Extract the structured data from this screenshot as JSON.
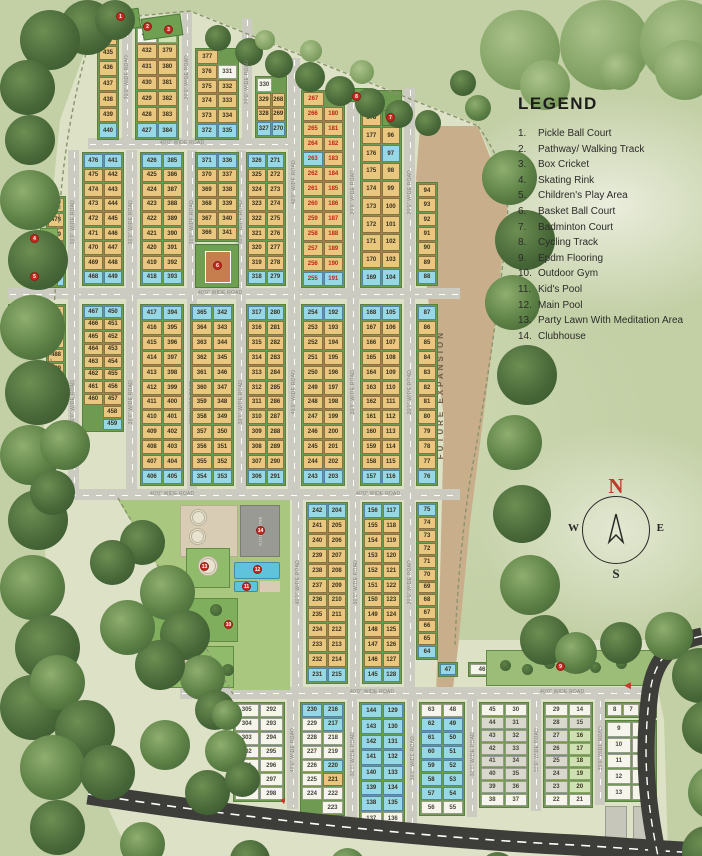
{
  "legend": {
    "title": "LEGEND",
    "items": [
      {
        "num": "1.",
        "label": "Pickle Ball Court"
      },
      {
        "num": "2.",
        "label": "Pathway/ Walking Track"
      },
      {
        "num": "3.",
        "label": "Box Cricket"
      },
      {
        "num": "4.",
        "label": "Skating Rink"
      },
      {
        "num": "5.",
        "label": "Children's Play Area"
      },
      {
        "num": "6.",
        "label": "Basket Ball Court"
      },
      {
        "num": "7.",
        "label": "Badminton Court"
      },
      {
        "num": "8.",
        "label": "Cycling Track"
      },
      {
        "num": "9.",
        "label": "Epdm Flooring"
      },
      {
        "num": "10.",
        "label": "Outdoor Gym"
      },
      {
        "num": "11.",
        "label": "Kid's Pool"
      },
      {
        "num": "12.",
        "label": "Main Pool"
      },
      {
        "num": "13.",
        "label": "Party Lawn With Meditation Area"
      },
      {
        "num": "14.",
        "label": "Clubhouse"
      }
    ]
  },
  "compass": {
    "n": "N",
    "e": "E",
    "s": "S",
    "w": "W"
  },
  "labels": {
    "future_expansion": "FUTURE EXPANSION",
    "clubhouse": "CLUBHOUSE",
    "road_40": "40'0\" WIDE ROAD",
    "road_30": "30'0\" WIDE ROAD"
  },
  "colors": {
    "plot_tan": "#e9c77e",
    "plot_blue": "#97d8e6",
    "plot_white": "#f6f5ec",
    "sold_red_text": "#c22314",
    "road_gray": "#cbcbc1",
    "future_tan": "#c8ae8a",
    "hedge_green": "#6f9a52",
    "marker_red": "#c52b20",
    "main_road_dark": "#3d3d39"
  },
  "markers": {
    "m1": "1",
    "m2": "2",
    "m3": "3",
    "m4": "4",
    "m5": "5",
    "m6": "6",
    "m7": "7",
    "m8": "8",
    "m9": "9",
    "m10": "10",
    "m11": "11",
    "m12": "12",
    "m13": "13",
    "m14": "14"
  },
  "plot_groups": {
    "g434": {
      "rows": [
        [
          "434:t"
        ],
        [
          "435:t"
        ],
        [
          "436:t"
        ],
        [
          "437:t"
        ],
        [
          "438:t"
        ],
        [
          "439:t"
        ],
        [
          "440:b"
        ]
      ]
    },
    "g433": {
      "rows": [
        [
          "433:w",
          "378:gr"
        ],
        [
          "432:t",
          "379:t"
        ],
        [
          "431:t",
          "380:t"
        ],
        [
          "430:t",
          "381:t"
        ],
        [
          "429:t",
          "382:t"
        ],
        [
          "428:t",
          "383:t"
        ],
        [
          "427:b",
          "384:b"
        ]
      ]
    },
    "g377": {
      "rows": [
        [
          "377:t",
          "."
        ],
        [
          "376:t",
          "331:w"
        ],
        [
          "375:t",
          "332:t"
        ],
        [
          "374:t",
          "333:t"
        ],
        [
          "373:t",
          "334:t"
        ],
        [
          "372:b",
          "335:b"
        ]
      ]
    },
    "g330": {
      "rows": [
        [
          "330:w",
          "."
        ],
        [
          "329:t",
          "268:t"
        ],
        [
          "328:t",
          "269:t"
        ],
        [
          "327:b",
          "270:b"
        ]
      ]
    },
    "g267": {
      "rows": [
        [
          "267:r",
          "."
        ],
        [
          "266:r",
          "180:r"
        ],
        [
          "265:r",
          "181:r"
        ],
        [
          "264:r",
          "182:r"
        ],
        [
          "263:rb",
          "183:r"
        ],
        [
          "262:r",
          "184:r"
        ],
        [
          "261:r",
          "185:r"
        ],
        [
          "260:r",
          "186:r"
        ],
        [
          "259:r",
          "187:r"
        ],
        [
          "258:r",
          "188:r"
        ],
        [
          "257:r",
          "189:r"
        ],
        [
          "256:r",
          "190:r"
        ],
        [
          "255:rb",
          "191:rb"
        ]
      ]
    },
    "g179": {
      "rows": [
        [
          "179:w",
          "."
        ],
        [
          "178:t",
          "95:w"
        ],
        [
          "177:t",
          "96:t"
        ],
        [
          "176:t",
          "97:b"
        ],
        [
          "175:t",
          "98:t"
        ],
        [
          "174:t",
          "99:t"
        ],
        [
          "173:t",
          "100:t"
        ],
        [
          "172:t",
          "101:t"
        ],
        [
          "171:t",
          "102:t"
        ],
        [
          "170:t",
          "103:t"
        ],
        [
          "169:b",
          "104:b"
        ]
      ]
    },
    "g94": {
      "rows": [
        [
          "94:t"
        ],
        [
          "93:t"
        ],
        [
          "92:t"
        ],
        [
          "91:t"
        ],
        [
          "90:t"
        ],
        [
          "89:t"
        ],
        [
          "88:b"
        ]
      ]
    },
    "g477": {
      "rows": [
        [
          "477:t"
        ],
        [
          "478:t"
        ],
        [
          "479:t"
        ],
        [
          "480:t"
        ],
        [
          "481:t"
        ],
        [
          "482:b"
        ]
      ]
    },
    "g476": {
      "rows": [
        [
          "476:b",
          "441:b"
        ],
        [
          "475:t",
          "442:t"
        ],
        [
          "474:t",
          "443:t"
        ],
        [
          "473:t",
          "444:t"
        ],
        [
          "472:t",
          "445:t"
        ],
        [
          "471:t",
          "446:t"
        ],
        [
          "470:t",
          "447:t"
        ],
        [
          "469:t",
          "448:t"
        ],
        [
          "468:b",
          "449:b"
        ]
      ]
    },
    "g426": {
      "rows": [
        [
          "426:b",
          "385:b"
        ],
        [
          "425:t",
          "386:t"
        ],
        [
          "424:t",
          "387:t"
        ],
        [
          "423:t",
          "388:t"
        ],
        [
          "422:t",
          "389:t"
        ],
        [
          "421:t",
          "390:t"
        ],
        [
          "420:t",
          "391:t"
        ],
        [
          "419:t",
          "392:t"
        ],
        [
          "418:b",
          "393:b"
        ]
      ]
    },
    "g371": {
      "rows": [
        [
          "371:b",
          "336:b"
        ],
        [
          "370:t",
          "337:t"
        ],
        [
          "369:t",
          "338:t"
        ],
        [
          "368:t",
          "339:t"
        ],
        [
          "367:t",
          "340:t"
        ],
        [
          "366:t",
          "341:t"
        ]
      ]
    },
    "g326": {
      "rows": [
        [
          "326:b",
          "271:b"
        ],
        [
          "325:t",
          "272:t"
        ],
        [
          "324:t",
          "273:t"
        ],
        [
          "323:t",
          "274:t"
        ],
        [
          "322:t",
          "275:t"
        ],
        [
          "321:t",
          "276:t"
        ],
        [
          "320:t",
          "277:t"
        ],
        [
          "319:t",
          "278:t"
        ],
        [
          "318:b",
          "279:b"
        ]
      ]
    },
    "g483": {
      "rows": [
        [
          "483:w",
          "484:t"
        ]
      ]
    },
    "g485": {
      "rows": [
        [
          "485:t"
        ],
        [
          "486:t"
        ],
        [
          "487:t"
        ],
        [
          "488:t"
        ],
        [
          "489:t"
        ]
      ]
    },
    "g467": {
      "rows": [
        [
          "467:b",
          "450:b"
        ],
        [
          "466:t",
          "451:t"
        ],
        [
          "465:t",
          "452:t"
        ],
        [
          "464:t",
          "453:t"
        ],
        [
          "463:t",
          "454:t"
        ],
        [
          "462:t",
          "455:t"
        ],
        [
          "461:t",
          "456:t"
        ],
        [
          "460:t",
          "457:t"
        ],
        [
          ".",
          "458:t"
        ],
        [
          ".",
          "459:b"
        ]
      ]
    },
    "g417": {
      "rows": [
        [
          "417:b",
          "394:b"
        ],
        [
          "416:t",
          "395:t"
        ],
        [
          "415:t",
          "396:t"
        ],
        [
          "414:t",
          "397:t"
        ],
        [
          "413:t",
          "398:t"
        ],
        [
          "412:t",
          "399:t"
        ],
        [
          "411:t",
          "400:t"
        ],
        [
          "410:t",
          "401:t"
        ],
        [
          "409:t",
          "402:t"
        ],
        [
          "408:t",
          "403:t"
        ],
        [
          "407:t",
          "404:t"
        ],
        [
          "406:b",
          "405:b"
        ]
      ]
    },
    "g365": {
      "rows": [
        [
          "365:b",
          "342:b"
        ],
        [
          "364:t",
          "343:t"
        ],
        [
          "363:t",
          "344:t"
        ],
        [
          "362:t",
          "345:t"
        ],
        [
          "361:t",
          "346:t"
        ],
        [
          "360:t",
          "347:t"
        ],
        [
          "359:t",
          "348:t"
        ],
        [
          "358:t",
          "349:t"
        ],
        [
          "357:t",
          "350:t"
        ],
        [
          "356:t",
          "351:t"
        ],
        [
          "355:t",
          "352:t"
        ],
        [
          "354:b",
          "353:b"
        ]
      ]
    },
    "g317": {
      "rows": [
        [
          "317:b",
          "280:b"
        ],
        [
          "316:t",
          "281:t"
        ],
        [
          "315:t",
          "282:t"
        ],
        [
          "314:t",
          "283:t"
        ],
        [
          "313:t",
          "284:t"
        ],
        [
          "312:t",
          "285:t"
        ],
        [
          "311:t",
          "286:t"
        ],
        [
          "310:t",
          "287:t"
        ],
        [
          "309:t",
          "288:t"
        ],
        [
          "308:t",
          "289:t"
        ],
        [
          "307:t",
          "290:t"
        ],
        [
          "306:b",
          "291:b"
        ]
      ]
    },
    "g254": {
      "rows": [
        [
          "254:b",
          "192:b"
        ],
        [
          "253:t",
          "193:t"
        ],
        [
          "252:t",
          "194:t"
        ],
        [
          "251:t",
          "195:t"
        ],
        [
          "250:t",
          "196:t"
        ],
        [
          "249:t",
          "197:t"
        ],
        [
          "248:t",
          "198:t"
        ],
        [
          "247:t",
          "199:t"
        ],
        [
          "246:t",
          "200:t"
        ],
        [
          "245:t",
          "201:t"
        ],
        [
          "244:t",
          "202:t"
        ],
        [
          "243:b",
          "203:b"
        ]
      ]
    },
    "g168": {
      "rows": [
        [
          "168:b",
          "105:b"
        ],
        [
          "167:t",
          "106:t"
        ],
        [
          "166:t",
          "107:t"
        ],
        [
          "165:t",
          "108:t"
        ],
        [
          "164:t",
          "109:t"
        ],
        [
          "163:t",
          "110:t"
        ],
        [
          "162:t",
          "111:t"
        ],
        [
          "161:t",
          "112:t"
        ],
        [
          "160:t",
          "113:t"
        ],
        [
          "159:t",
          "114:t"
        ],
        [
          "158:t",
          "115:t"
        ],
        [
          "157:b",
          "116:b"
        ]
      ]
    },
    "g87": {
      "rows": [
        [
          "87:b"
        ],
        [
          "86:t"
        ],
        [
          "85:t"
        ],
        [
          "84:t"
        ],
        [
          "83:t"
        ],
        [
          "82:t"
        ],
        [
          "81:t"
        ],
        [
          "80:t"
        ],
        [
          "79:t"
        ],
        [
          "78:t"
        ],
        [
          "77:t"
        ],
        [
          "76:b"
        ]
      ]
    },
    "g242": {
      "rows": [
        [
          "242:b",
          "204:b"
        ],
        [
          "241:t",
          "205:t"
        ],
        [
          "240:t",
          "206:t"
        ],
        [
          "239:t",
          "207:t"
        ],
        [
          "238:t",
          "208:t"
        ],
        [
          "237:t",
          "209:t"
        ],
        [
          "236:t",
          "210:t"
        ],
        [
          "235:t",
          "211:t"
        ],
        [
          "234:t",
          "212:t"
        ],
        [
          "233:t",
          "213:t"
        ],
        [
          "232:t",
          "214:t"
        ],
        [
          "231:b",
          "215:b"
        ]
      ]
    },
    "g156": {
      "rows": [
        [
          "156:b",
          "117:b"
        ],
        [
          "155:t",
          "118:t"
        ],
        [
          "154:t",
          "119:t"
        ],
        [
          "153:t",
          "120:t"
        ],
        [
          "152:t",
          "121:t"
        ],
        [
          "151:t",
          "122:t"
        ],
        [
          "150:t",
          "123:t"
        ],
        [
          "149:t",
          "124:t"
        ],
        [
          "148:t",
          "125:t"
        ],
        [
          "147:t",
          "126:t"
        ],
        [
          "146:t",
          "127:t"
        ],
        [
          "145:b",
          "128:b"
        ]
      ]
    },
    "g75": {
      "rows": [
        [
          "75:b"
        ],
        [
          "74:t"
        ],
        [
          "73:t"
        ],
        [
          "72:t"
        ],
        [
          "71:t"
        ],
        [
          "70:t"
        ],
        [
          "69:t"
        ],
        [
          "68:t"
        ],
        [
          "67:t"
        ],
        [
          "66:t"
        ],
        [
          "65:t"
        ],
        [
          "64:b"
        ]
      ]
    },
    "g47": {
      "rows": [
        [
          "47:b"
        ]
      ]
    },
    "g46": {
      "rows": [
        [
          "46:w"
        ]
      ]
    },
    "g305": {
      "rows": [
        [
          "305:w",
          "292:w"
        ],
        [
          "304:w",
          "293:w"
        ],
        [
          "303:w",
          "294:w"
        ],
        [
          "302:w",
          "295:w"
        ],
        [
          "301:w",
          "296:w"
        ],
        [
          "300:w",
          "297:w"
        ],
        [
          "299:w",
          "298:w"
        ]
      ]
    },
    "g230": {
      "rows": [
        [
          "230:b",
          "216:b"
        ],
        [
          "229:w",
          "217:b"
        ],
        [
          "228:w",
          "218:w"
        ],
        [
          "227:w",
          "219:w"
        ],
        [
          "226:w",
          "220:b"
        ],
        [
          "225:w",
          "221:t"
        ],
        [
          "224:w",
          "222:w"
        ],
        [
          ".",
          "223:w"
        ]
      ]
    },
    "g144": {
      "rows": [
        [
          "144:b",
          "129:b"
        ],
        [
          "143:b",
          "130:b"
        ],
        [
          "142:b",
          "131:b"
        ],
        [
          "141:b",
          "132:b"
        ],
        [
          "140:b",
          "133:b"
        ],
        [
          "139:b",
          "134:b"
        ],
        [
          "138:b",
          "135:b"
        ],
        [
          "137:w",
          "136:w"
        ]
      ]
    },
    "g63": {
      "rows": [
        [
          "63:w",
          "48:w"
        ],
        [
          "62:b",
          "49:b"
        ],
        [
          "61:b",
          "50:b"
        ],
        [
          "60:b",
          "51:b"
        ],
        [
          "59:b",
          "52:b"
        ],
        [
          "58:b",
          "53:b"
        ],
        [
          "57:b",
          "54:b"
        ],
        [
          "56:w",
          "55:w"
        ]
      ]
    },
    "g45": {
      "rows": [
        [
          "45:w",
          "30:w"
        ],
        [
          "44:g",
          "31:g"
        ],
        [
          "43:g",
          "32:g"
        ],
        [
          "42:g",
          "33:g"
        ],
        [
          "41:g",
          "34:g"
        ],
        [
          "40:g",
          "35:g"
        ],
        [
          "39:g",
          "36:g"
        ],
        [
          "38:w",
          "37:w"
        ]
      ]
    },
    "g29": {
      "rows": [
        [
          "29:w",
          "14:w"
        ],
        [
          "28:g",
          "15:g"
        ],
        [
          "27:g",
          "16:gr"
        ],
        [
          "26:g",
          "17:gr"
        ],
        [
          "25:g",
          "18:gr"
        ],
        [
          "24:g",
          "19:gr"
        ],
        [
          "23:g",
          "20:gr"
        ],
        [
          "22:w",
          "21:w"
        ]
      ]
    },
    "g876": {
      "rows": [
        [
          "8:w",
          "7:w",
          "6:w"
        ]
      ]
    },
    "g9": {
      "rows": [
        [
          "9:w",
          "5:w"
        ],
        [
          "10:w",
          "4:w"
        ],
        [
          "11:w",
          "3:w"
        ],
        [
          "12:w",
          "2:w"
        ],
        [
          "13:w",
          "1:w"
        ]
      ]
    }
  }
}
